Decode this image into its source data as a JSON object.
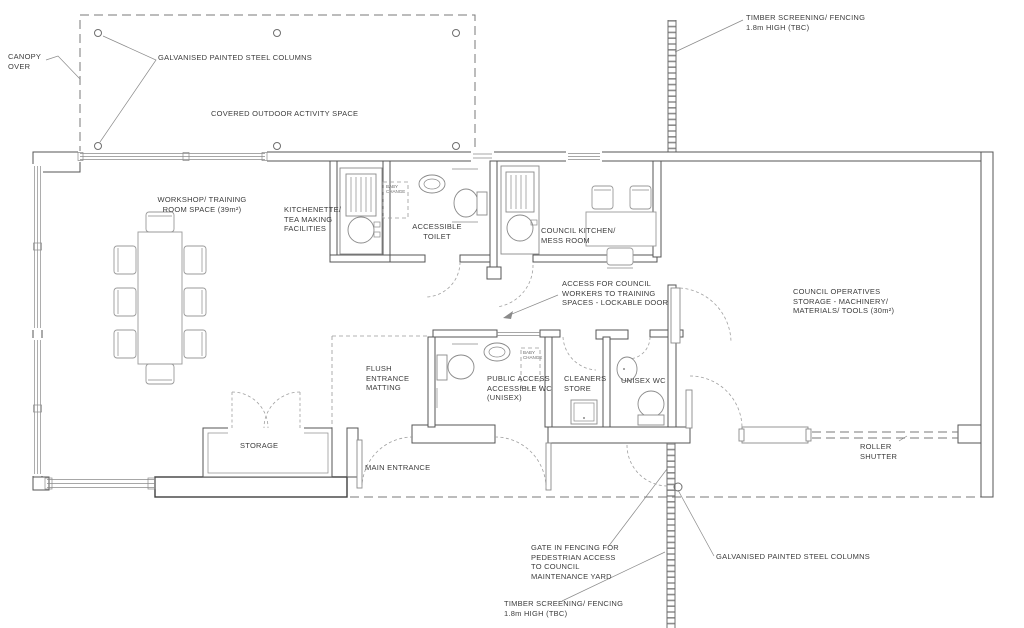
{
  "drawing": {
    "type": "architectural floor plan",
    "colors": {
      "line": "#6f6f6f",
      "wall": "#555555",
      "text": "#3c3c3c",
      "background": "#ffffff"
    }
  },
  "labels": {
    "canopy_over": "CANOPY\nOVER",
    "galvanised_columns_top": "GALVANISED PAINTED STEEL  COLUMNS",
    "covered_outdoor": "COVERED OUTDOOR ACTIVITY SPACE",
    "timber_fencing_north": "TIMBER SCREENING/ FENCING\n1.8m HIGH (TBC)",
    "workshop": "WORKSHOP/ TRAINING\nROOM SPACE  (39m²)",
    "kitchenette": "KITCHENETTE/\nTEA MAKING\nFACILITIES",
    "accessible_toilet": "ACCESSIBLE\nTOILET",
    "council_kitchen": "COUNCIL KITCHEN/\nMESS ROOM",
    "access_door": "ACCESS FOR COUNCIL\nWORKERS TO TRAINING\nSPACES - LOCKABLE DOOR",
    "council_storage": "COUNCIL OPERATIVES\nSTORAGE  -  MACHINERY/\nMATERIALS/ TOOLS (30m²)",
    "flush_matting": "FLUSH\nENTRANCE\nMATTING",
    "public_wc": "PUBLIC ACCESS\nACCESSIBLE WC\n(UNISEX)",
    "cleaners_store": "CLEANERS\nSTORE",
    "unisex_wc": "UNISEX WC",
    "storage": "STORAGE",
    "main_entrance": "MAIN ENTRANCE",
    "roller_shutter": "ROLLER\nSHUTTER",
    "gate_fencing": "GATE IN FENCING FOR\nPEDESTRIAN ACCESS\nTO COUNCIL\nMAINTENANCE YARD",
    "galvanised_columns_bottom": "GALVANISED PAINTED STEEL  COLUMNS",
    "timber_fencing_south": "TIMBER SCREENING/ FENCING\n1.8m HIGH (TBC)",
    "baby_change_1": "BABY\nCHANGE",
    "baby_change_2": "BABY\nCHANGE"
  }
}
